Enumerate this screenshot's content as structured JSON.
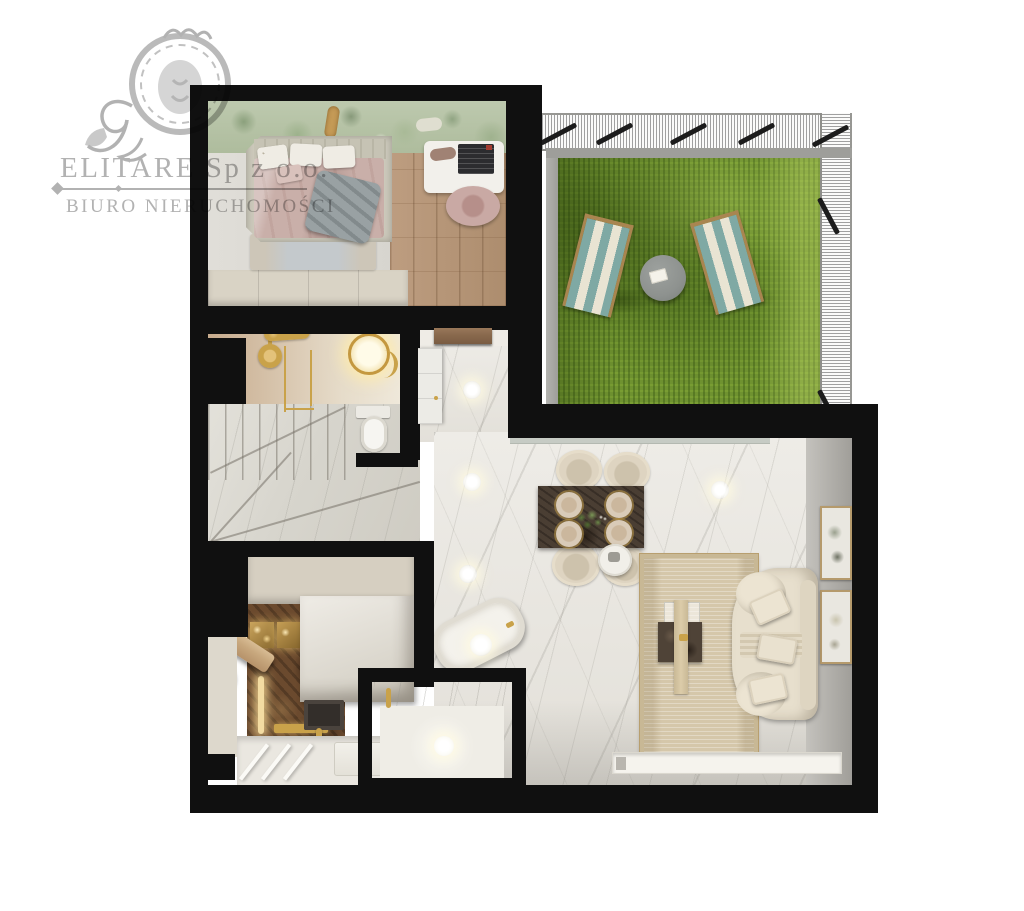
{
  "watermark": {
    "company": "ELITARE Sp z o.o.",
    "tagline": "BIURO NIERUCHOMOŚCI",
    "text_color": "#b2b2b2",
    "emblem": "lion-crest-icon"
  },
  "scene": {
    "kind": "3d-floor-plan-render-top-view",
    "background_color": "#ffffff",
    "wall_color": "#101010",
    "rooms": [
      {
        "name": "bedroom",
        "position": "top-left",
        "features": [
          "jungle-mural-wallpaper",
          "upholstered-double-bed",
          "patterned-pillows",
          "gray-throw-blanket",
          "blue-beige-rug",
          "white-desk",
          "laptop",
          "round-desk-chair",
          "built-in-wardrobe",
          "oak-plank-floor"
        ]
      },
      {
        "name": "bathroom",
        "position": "mid-left",
        "features": [
          "walk-in-shower",
          "gold-rain-shower-head",
          "gold-glass-partition",
          "illuminated-round-mirror",
          "toilet",
          "tan-stone-walls"
        ]
      },
      {
        "name": "staircase",
        "position": "mid-left-lower",
        "features": [
          "marble-winder-stairs"
        ]
      },
      {
        "name": "kitchen",
        "position": "bottom-left",
        "features": [
          "brown-emperador-marble",
          "illuminated-niches",
          "led-strip",
          "white-marble-island",
          "dark-undermount-sink",
          "gold-faucet",
          "wooden-bar-shelf",
          "black-round-stool",
          "cream-cabinets"
        ]
      },
      {
        "name": "bathroom-two",
        "position": "bottom-center",
        "features": [
          "tilted-bathtub",
          "walk-in-shower-room",
          "gold-hand-shower",
          "marble-walls",
          "ceiling-light"
        ]
      },
      {
        "name": "hallway",
        "position": "center",
        "features": [
          "marble-floor",
          "wooden-entrance-door",
          "built-in-closet",
          "ceiling-spotlights"
        ]
      },
      {
        "name": "living-room",
        "position": "right",
        "features": [
          "white-marble-floor",
          "dark-marble-dining-table",
          "four-cream-dining-chairs",
          "plate-settings",
          "plant-centerpiece",
          "beige-area-rug",
          "marble-coffee-table",
          "table-runner",
          "curved-cream-sofa",
          "three-sofa-pillows",
          "round-side-table",
          "two-wall-art-frames",
          "recessed-tv-console",
          "sliding-glass-door",
          "ceiling-spotlights"
        ]
      },
      {
        "name": "terrace",
        "position": "top-right",
        "features": [
          "artificial-grass",
          "two-striped-deck-chairs",
          "round-coffee-table",
          "open-book",
          "wire-mesh-railing",
          "black-railing-posts",
          "concrete-border"
        ]
      }
    ]
  },
  "palette": {
    "wall": "#101010",
    "grass": "#6f9230",
    "grass_shadow": "#47651a",
    "lounger_teal": "#7fa9a4",
    "lounger_cream": "#ece7d6",
    "lounger_wood": "#a98550",
    "wood_floor": "#b6977a",
    "marble_light": "#e9e7e1",
    "marble_stairs": "#d9d7cf",
    "brown_marble": "#6b4a2e",
    "gold": "#c9a24a",
    "cream_furniture": "#ded4c1",
    "rug_beige": "#d5c7aa",
    "rug_bedroom": "#c5cacd",
    "sofa_cream": "#e7dfcd",
    "dining_table": "#4a3e33",
    "bedding_pink": "#c9afa9",
    "throw_gray": "#99a1a3",
    "mural_green": "#b3c0a4",
    "concrete": "#a8a8a4",
    "glass_door": "#c6cbc4"
  }
}
